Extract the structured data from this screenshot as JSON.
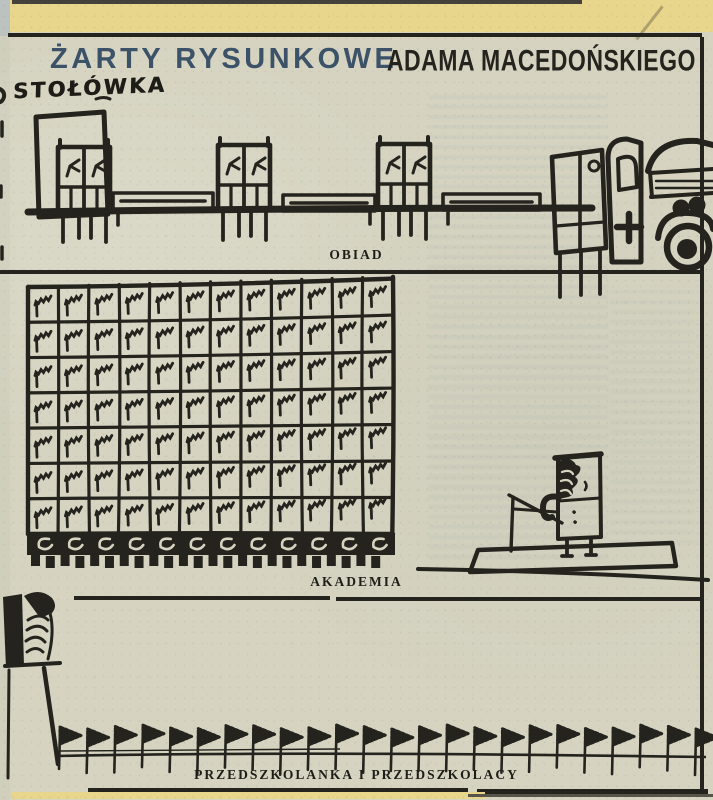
{
  "header": {
    "title": "ŻARTY RYSUNKOWE",
    "byline": "ADAMA MACEDOŃSKIEGO",
    "handwritten_note": "STOŁÓWKA"
  },
  "cartoons": [
    {
      "caption": "OBIAD",
      "scene": "pairs of children at canteen tables in a row, ambulance van with open door and cross arriving at right"
    },
    {
      "caption": "AKADEMIA",
      "scene": "huge grandstand grid of sleeping children facing a lone speaker at a rostrum"
    },
    {
      "caption": "PRZEDSZKOLANKA I PRZEDSZKOLACY",
      "scene": "teacher as a large banner head on a pole leading a long row of tiny pennant children"
    }
  ],
  "drawings": {
    "akademia_grid": {
      "rows": 7,
      "cols": 12,
      "front_row_hooks": 12,
      "feet": 24
    },
    "pennants": {
      "count": 24
    }
  },
  "colors": {
    "paper": "#d6d4c1",
    "ink": "#24231d",
    "title_blue": "#3c5268",
    "edge_yellow": "#e7d68c"
  }
}
